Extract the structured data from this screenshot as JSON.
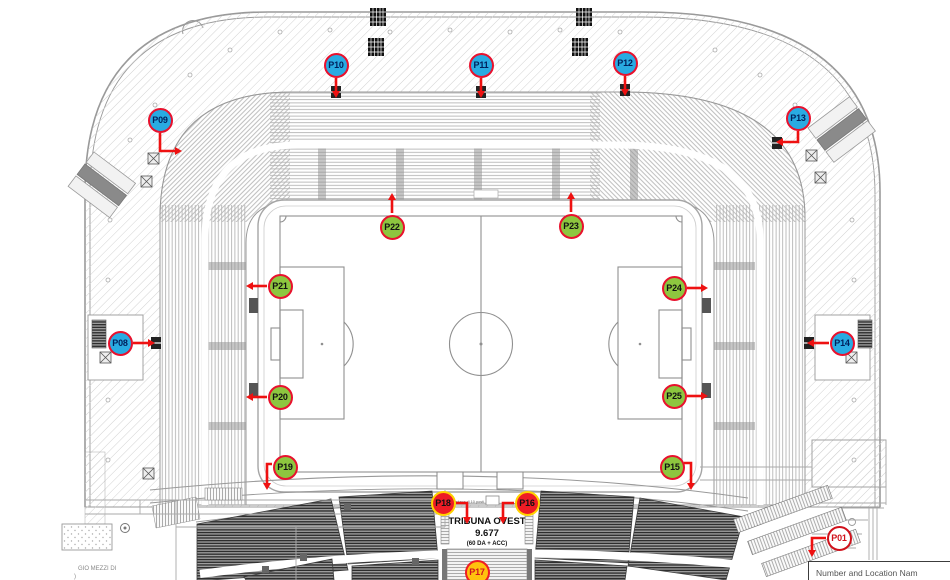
{
  "arrow_color": "#ee1111",
  "marker_styles": {
    "blue": {
      "fill": "#29abe2",
      "border": "#e8112d",
      "text": "#00205b"
    },
    "green": {
      "fill": "#8dc63f",
      "border": "#e8112d",
      "text": "#111111"
    },
    "red": {
      "fill": "#ee1c25",
      "border": "#ffd200",
      "text": "#111111"
    },
    "yellow": {
      "fill": "#ffc20e",
      "border": "#ee1c25",
      "text": "#cf1020"
    },
    "white": {
      "fill": "#ffffff",
      "border": "#d0111b",
      "text": "#d0111b"
    }
  },
  "markers": [
    {
      "label": "P01",
      "style": "white",
      "x": 839,
      "y": 538,
      "arrow": [
        [
          826,
          538
        ],
        [
          812,
          538
        ],
        [
          812,
          550
        ]
      ]
    },
    {
      "label": "P08",
      "style": "blue",
      "x": 120,
      "y": 343,
      "arrow": [
        [
          133,
          343
        ],
        [
          148,
          343
        ]
      ]
    },
    {
      "label": "P09",
      "style": "blue",
      "x": 160,
      "y": 120,
      "arrow": [
        [
          160,
          133
        ],
        [
          160,
          151
        ],
        [
          175,
          151
        ]
      ]
    },
    {
      "label": "P10",
      "style": "blue",
      "x": 336,
      "y": 65,
      "arrow": [
        [
          336,
          78
        ],
        [
          336,
          91
        ]
      ]
    },
    {
      "label": "P11",
      "style": "blue",
      "x": 481,
      "y": 65,
      "arrow": [
        [
          481,
          78
        ],
        [
          481,
          91
        ]
      ]
    },
    {
      "label": "P12",
      "style": "blue",
      "x": 625,
      "y": 63,
      "arrow": [
        [
          625,
          76
        ],
        [
          625,
          89
        ]
      ]
    },
    {
      "label": "P13",
      "style": "blue",
      "x": 798,
      "y": 118,
      "arrow": [
        [
          798,
          131
        ],
        [
          798,
          142
        ],
        [
          783,
          142
        ]
      ]
    },
    {
      "label": "P14",
      "style": "blue",
      "x": 842,
      "y": 343,
      "arrow": [
        [
          829,
          343
        ],
        [
          814,
          343
        ]
      ]
    },
    {
      "label": "P15",
      "style": "green",
      "x": 672,
      "y": 467,
      "arrow": [
        [
          684,
          463
        ],
        [
          691,
          463
        ],
        [
          691,
          483
        ]
      ]
    },
    {
      "label": "P16",
      "style": "red",
      "x": 527,
      "y": 503,
      "arrow": [
        [
          514,
          503
        ],
        [
          503,
          503
        ],
        [
          503,
          517
        ]
      ]
    },
    {
      "label": "P17",
      "style": "yellow",
      "x": 477,
      "y": 572
    },
    {
      "label": "P18",
      "style": "red",
      "x": 443,
      "y": 503,
      "arrow": [
        [
          456,
          503
        ],
        [
          467,
          503
        ],
        [
          467,
          517
        ]
      ]
    },
    {
      "label": "P19",
      "style": "green",
      "x": 285,
      "y": 467,
      "arrow": [
        [
          272,
          464
        ],
        [
          267,
          464
        ],
        [
          267,
          483
        ]
      ]
    },
    {
      "label": "P20",
      "style": "green",
      "x": 280,
      "y": 397,
      "arrow": [
        [
          267,
          397
        ],
        [
          253,
          397
        ]
      ]
    },
    {
      "label": "P21",
      "style": "green",
      "x": 280,
      "y": 286,
      "arrow": [
        [
          267,
          286
        ],
        [
          253,
          286
        ]
      ]
    },
    {
      "label": "P22",
      "style": "green",
      "x": 392,
      "y": 227,
      "arrow": [
        [
          392,
          213
        ],
        [
          392,
          200
        ]
      ]
    },
    {
      "label": "P23",
      "style": "green",
      "x": 571,
      "y": 226,
      "arrow": [
        [
          571,
          212
        ],
        [
          571,
          199
        ]
      ]
    },
    {
      "label": "P24",
      "style": "green",
      "x": 674,
      "y": 288,
      "arrow": [
        [
          687,
          288
        ],
        [
          701,
          288
        ]
      ]
    },
    {
      "label": "P25",
      "style": "green",
      "x": 674,
      "y": 396,
      "arrow": [
        [
          687,
          396
        ],
        [
          701,
          396
        ]
      ]
    }
  ],
  "texts": {
    "tribuna_name": "TRIBUNA OVEST",
    "tribuna_capacity": "9.677",
    "tribuna_note": "(60 DA + ACC)",
    "platform_note": "Pedana di 10 posti",
    "margin_note1": "GIO MEZZI DI",
    "margin_note2": ")",
    "legend": "Number and Location Nam"
  }
}
